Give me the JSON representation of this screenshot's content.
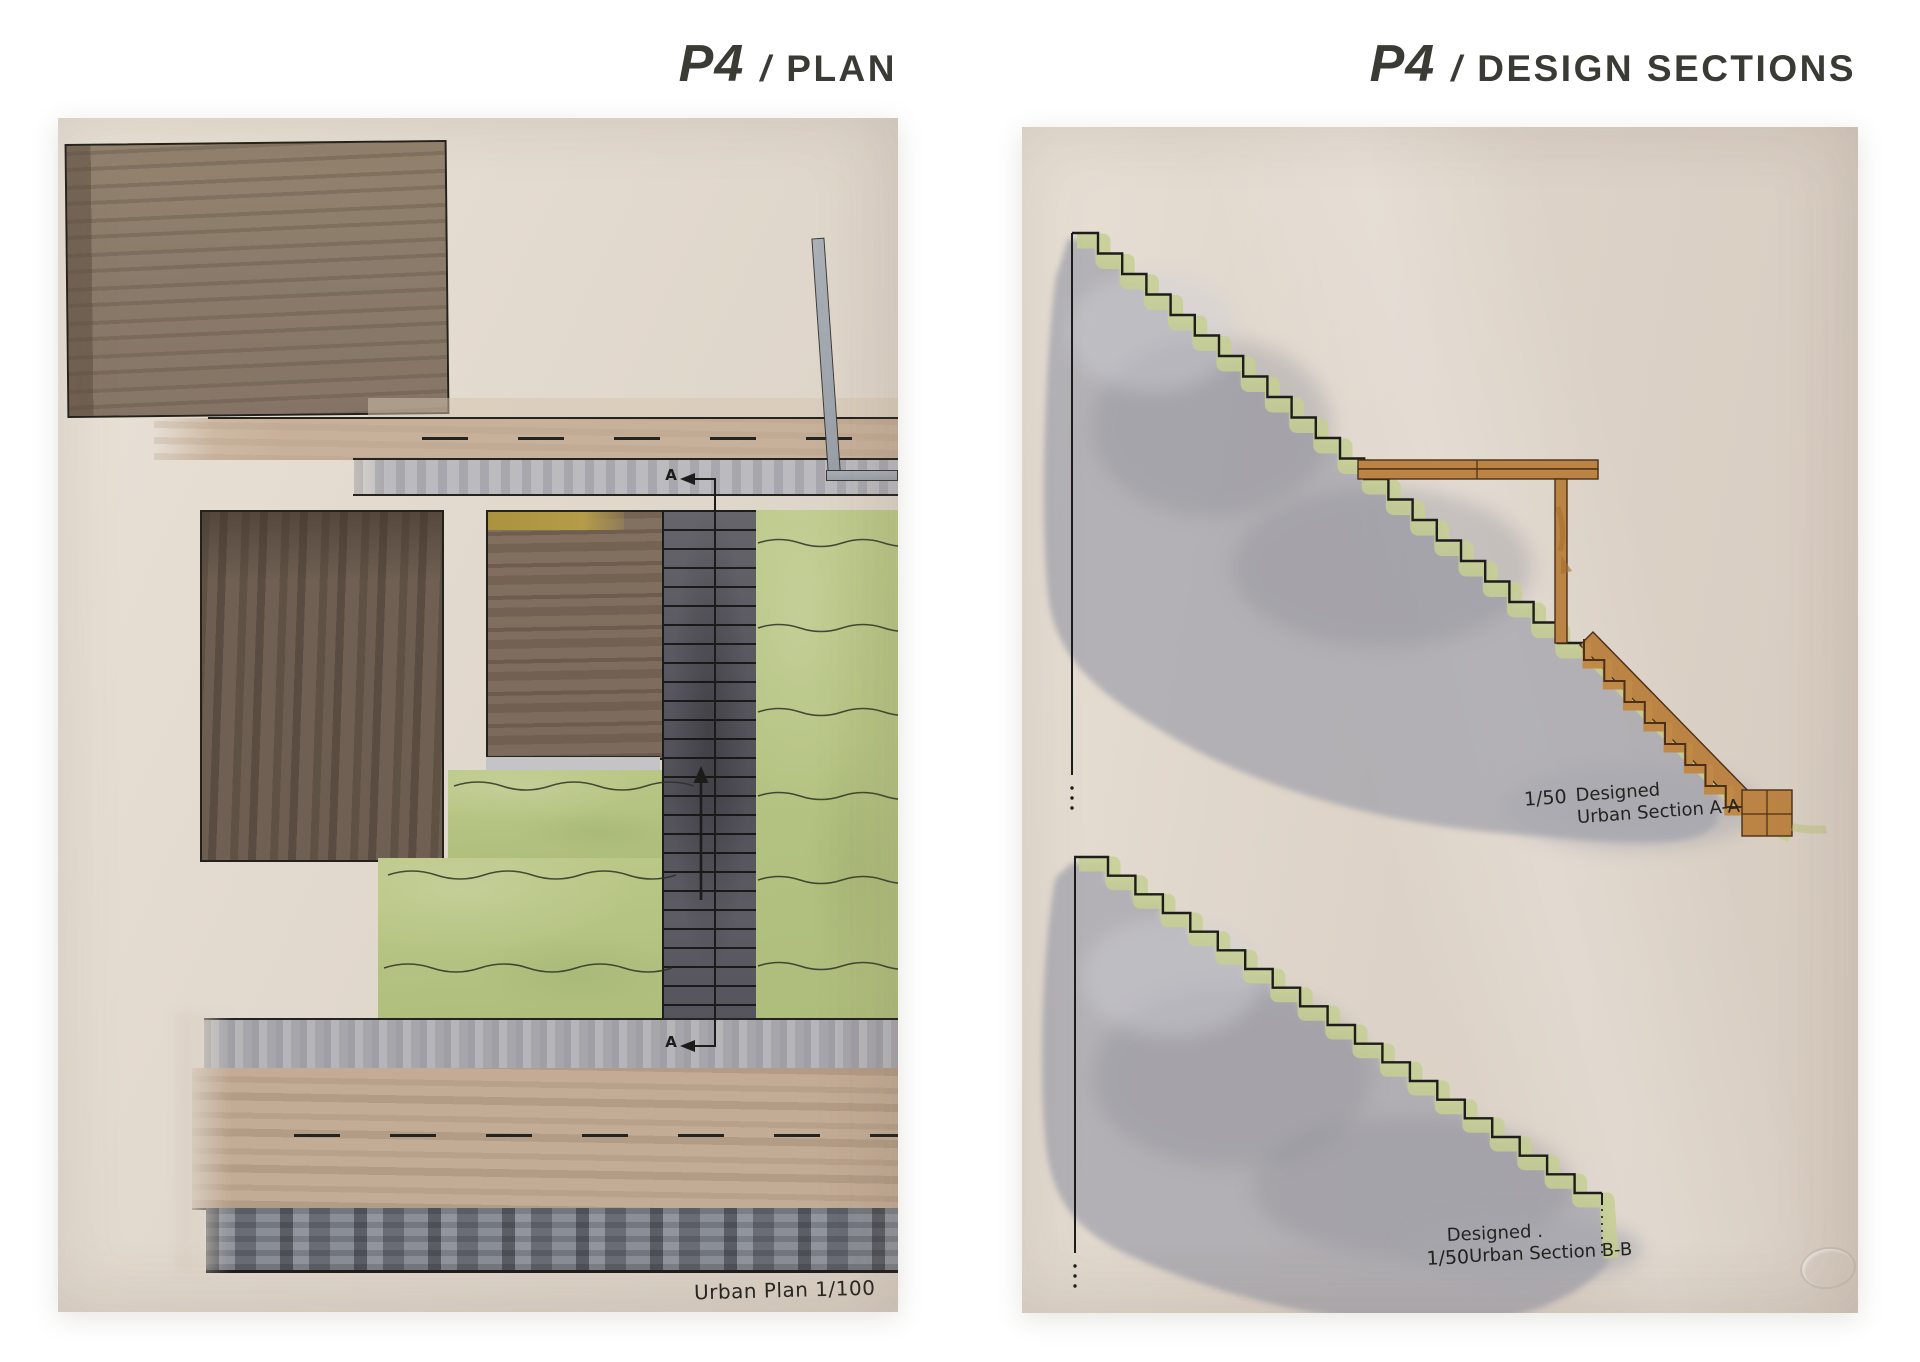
{
  "titles": {
    "left": {
      "code": "P4",
      "sep": "/",
      "label": "PLAN"
    },
    "right": {
      "code": "P4",
      "sep": "/",
      "label": "DESIGN SECTIONS"
    }
  },
  "plan": {
    "caption": "Urban Plan 1/100",
    "section_marker": "A"
  },
  "sections": {
    "a": {
      "scale": "1/50",
      "line1": "Designed",
      "line2": "Urban Section A-A"
    },
    "b": {
      "scale": "1/50",
      "line1": "Designed .",
      "line2": "Urban Section B-B"
    }
  },
  "palette": {
    "background": "#ffffff",
    "paper": "#e2d9cd",
    "ink": "#22221f",
    "title_ink": "#3b3b36",
    "watercolor_gray": "#a6a6ae",
    "grass_green": "#b9c685",
    "slope_green": "#c6cf92",
    "wood_orange": "#bb8344",
    "road_tan": "#c7b19b",
    "sidewalk_gray": "#b5b5b9",
    "building_brown": "#8b7b6b",
    "building_dark_brown": "#6a5b4f",
    "stair_gray": "#56555c",
    "yellow_accent": "#ac9440"
  }
}
